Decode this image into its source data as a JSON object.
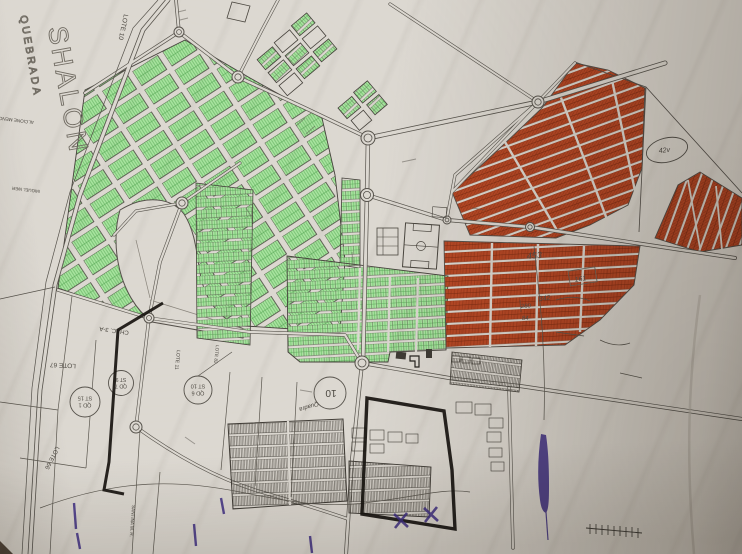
{
  "photo": {
    "paper_color": "#dcd8d1",
    "ink_color": "#4a463f",
    "green_fill": "#a8e49f",
    "green_line": "#4a9e4a",
    "orange_fill": "#c9512b",
    "orange_line": "#76280e",
    "marker_black": "#17140f",
    "marker_purple": "#3f2f85",
    "pencil": "#5b574f"
  },
  "labels": {
    "shalon": "SHALON",
    "estate_word": "QUEBRADA",
    "lote10": "LOTE 10",
    "alcione": "ALCIONE MENCK",
    "miguel": "MIGUEL WER",
    "lote67": "LOTE 67",
    "lote66": "LOTE 66",
    "chac": "CHAC. 3-A",
    "lote11": "LOTE 11",
    "lote82": "LOTE 82",
    "santina": "SANTINA M. R.",
    "qd1": {
      "l1": "QD 1",
      "l2": "ST 15"
    },
    "qd7": {
      "l1": "QD 7",
      "l2": "ST 9"
    },
    "qd6": {
      "l1": "QD 6",
      "l2": "ST 10"
    },
    "quadra": {
      "word": "Quadra",
      "num": "10"
    }
  },
  "handwritten": {
    "n453": "453",
    "n342": "342",
    "n280": "280",
    "n84": "84",
    "n161": "161",
    "n42v": "42v"
  }
}
